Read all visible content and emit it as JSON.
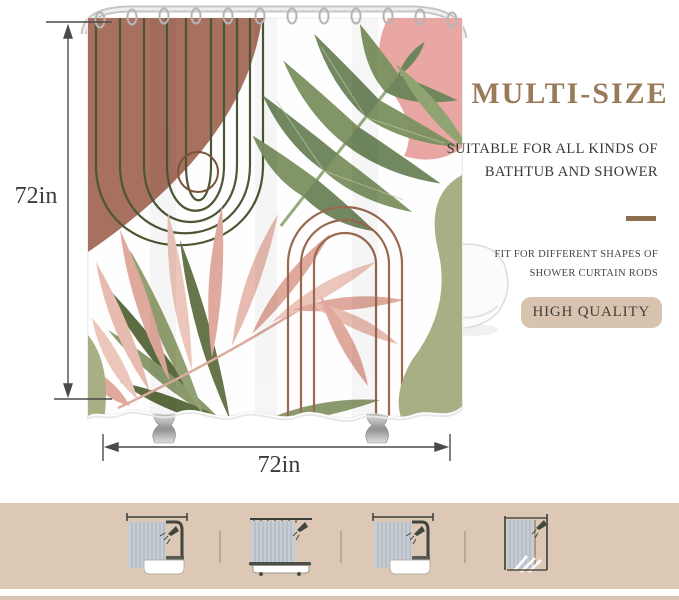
{
  "scene": {
    "height_label": "72in",
    "width_label": "72in"
  },
  "panel": {
    "title": "MULTI-SIZE",
    "subtitle_line1": "SUITABLE FOR ALL KINDS OF",
    "subtitle_line2": "BATHTUB AND SHOWER",
    "feature_line1": "FIT FOR DIFFERENT SHAPES OF",
    "feature_line2": "SHOWER CURTAIN RODS",
    "badge": "HIGH QUALITY"
  },
  "colors": {
    "title_brown": "#9a7b59",
    "divider_brown": "#8b6f4e",
    "badge_background": "#d8c3ae",
    "strip_background": "#dcc8b5",
    "curtain_terracotta": "#a7705f",
    "curtain_olive_line": "#4c5735",
    "curtain_brown_arch": "#9a6950",
    "curtain_sage": "#a9af85",
    "curtain_pink": "#e9a7a3",
    "curtain_blush_palm": "#e7b9ae",
    "curtain_leaf_green": "#7c9160"
  },
  "bottom_strip": {
    "items": [
      {
        "icon": "bathtub-with-straight-rod"
      },
      {
        "icon": "clawfoot-tub-with-rod"
      },
      {
        "icon": "bathtub-with-corner-rod"
      },
      {
        "icon": "walk-in-shower"
      }
    ]
  }
}
